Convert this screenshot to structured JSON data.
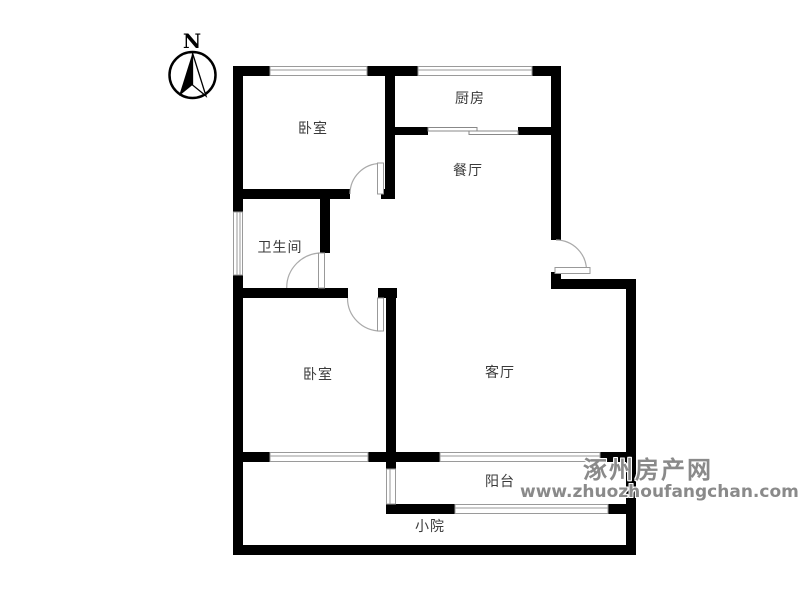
{
  "compass": {
    "label": "N"
  },
  "rooms": {
    "bedroom_top": {
      "label": "卧室"
    },
    "kitchen": {
      "label": "厨房"
    },
    "dining": {
      "label": "餐厅"
    },
    "bathroom": {
      "label": "卫生间"
    },
    "bedroom_bottom": {
      "label": "卧室"
    },
    "living": {
      "label": "客厅"
    },
    "balcony": {
      "label": "阳台"
    },
    "yard": {
      "label": "小院"
    }
  },
  "watermark": {
    "site_name": "涿州房产网",
    "site_url": "www.zhuozhoufangchan.com"
  },
  "colors": {
    "wall": "#000000",
    "window_line": "#9a9a9a",
    "door_arc": "#aaaaaa",
    "room_label": "#3a3a3a",
    "watermark_text": "#8a8a8a",
    "background": "#ffffff"
  }
}
